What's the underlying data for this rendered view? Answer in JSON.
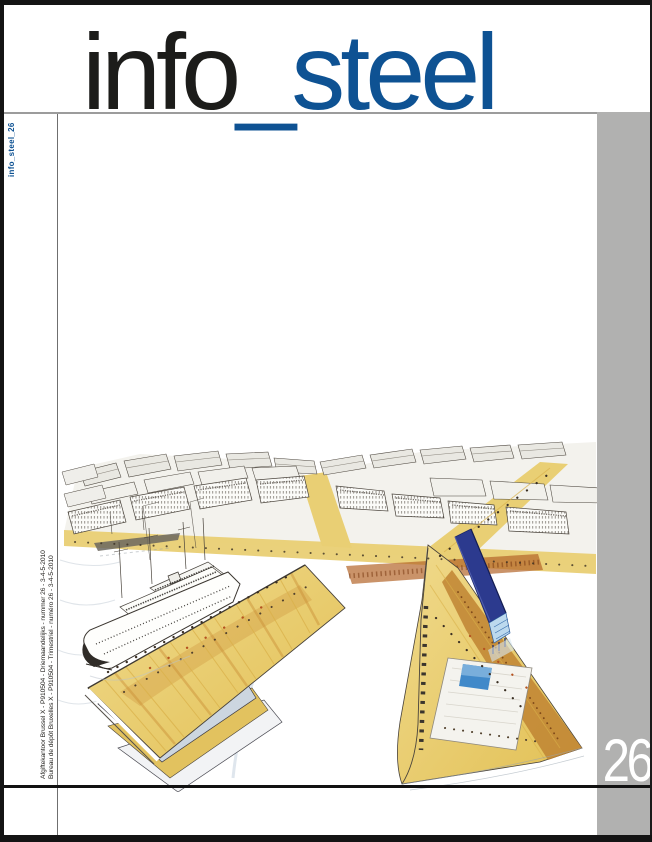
{
  "masthead": {
    "title_part_black": "info",
    "title_part_blue": "_steel"
  },
  "spine_label": "info_steel_26",
  "issue_number": "26",
  "imprint": {
    "line_nl": "Afgiftekantoor Brussel X - P910504 -  Driemaandelijks - nummer 26 -  3-4-5-2010",
    "line_fr": "Bureau de dépôt Bruxelles X - P910504 -  Trimestriel -  numéro 26 -  3-4-5-2010"
  },
  "colors": {
    "accent_blue": "#0e5293",
    "sidebar_gray": "#b1b1b0",
    "frame_black": "#141414",
    "quay_yellow": "#ead174",
    "ochre_brown": "#c08433",
    "rust_band": "#b4652a",
    "slab_building_blue": "#2c3a8e",
    "pool_blue": "#4189c9",
    "sketch_ink": "#3f3a33"
  },
  "cover_art_alt": "Hand-drawn aerial perspective of a harbour district: yellow quays, an ocean liner moored at a long pier, dense white city blocks, a dark blue slab building and a pier with plaza and pool"
}
